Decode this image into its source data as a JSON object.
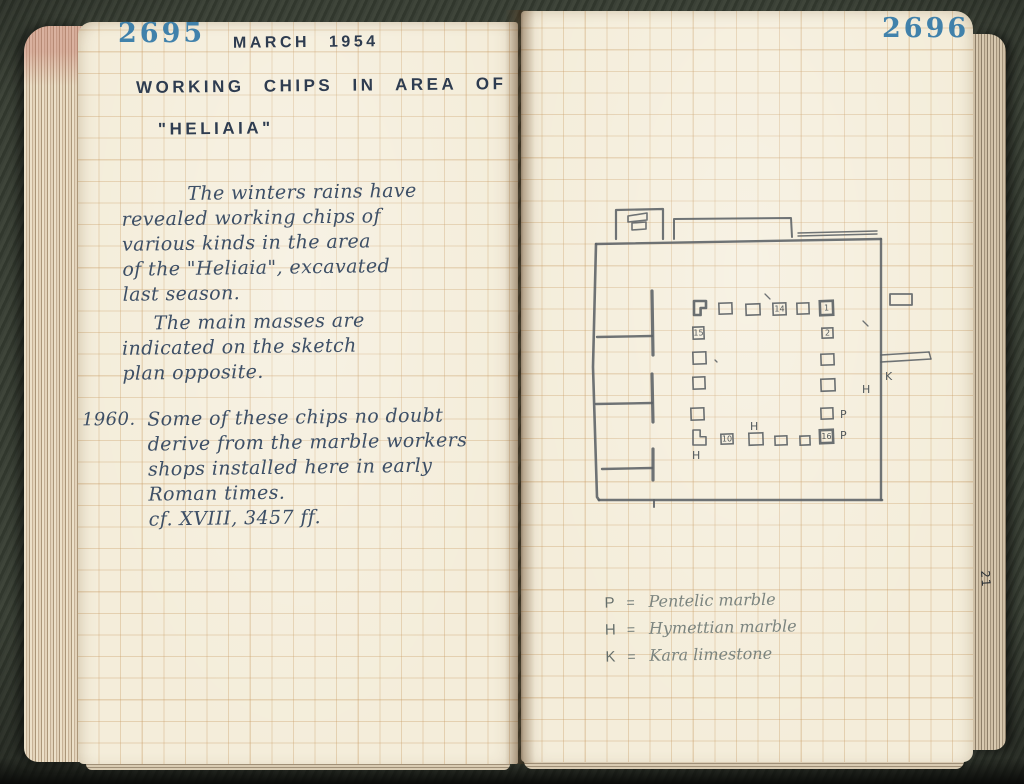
{
  "book": {
    "left_page_number": "2695",
    "right_page_number": "2696",
    "edge_marking": "21"
  },
  "left_page": {
    "date_heading": "MARCH 1954",
    "title_line1": "WORKING CHIPS IN AREA OF",
    "title_line2": "\"HELIAIA\"",
    "paragraph1_lines": [
      "The winters rains have",
      "revealed working chips of",
      "various kinds in the area",
      "of the \"Heliaia\", excavated",
      "last season."
    ],
    "paragraph2_lines": [
      "The main masses are",
      "indicated on the sketch",
      "plan opposite."
    ],
    "marginal_year": "1960.",
    "note_lines": [
      "Some of these chips no doubt",
      "derive from the marble workers",
      "shops installed here in early",
      "Roman times.",
      "cf. XVIII, 3457 ff."
    ]
  },
  "right_page": {
    "legend": [
      {
        "symbol": "P",
        "eq": "=",
        "meaning": "Pentelic marble"
      },
      {
        "symbol": "H",
        "eq": "=",
        "meaning": "Hymettian marble"
      },
      {
        "symbol": "K",
        "eq": "=",
        "meaning": "Kara limestone"
      }
    ],
    "plan": {
      "description": "pencil sketch plan of the Heliaia showing masses of working chips",
      "stroke_color": "#5b6165",
      "label_color": "#51585c",
      "walls": [
        {
          "points": "17,57 302,52",
          "w": 2.4
        },
        {
          "points": "302,52 302,313",
          "w": 2.4
        },
        {
          "points": "20,313 303,313",
          "w": 2.6
        },
        {
          "points": "17,57 14,180 18,310 20,313",
          "w": 2.6
        },
        {
          "points": "37,52 37,23 84,22 84,52",
          "w": 2.2
        },
        {
          "points": "49,29 68,26 68,33 49,35 49,29",
          "w": 1.6
        },
        {
          "points": "53,36 67,35 67,42 53,43 53,36",
          "w": 1.6
        },
        {
          "points": "95,52 95,32 212,31 213,50",
          "w": 2.0
        },
        {
          "points": "219,46 298,44",
          "w": 1.4
        },
        {
          "points": "219,49 298,47",
          "w": 1.4
        },
        {
          "points": "73,104 74,168",
          "w": 3.2
        },
        {
          "points": "73,187 74,235",
          "w": 3.2
        },
        {
          "points": "74,262 74,293",
          "w": 3.2
        },
        {
          "points": "18,150 73,149",
          "w": 2.4
        },
        {
          "points": "17,217 73,216",
          "w": 2.4
        },
        {
          "points": "23,282 73,281",
          "w": 2.4
        },
        {
          "points": "75,313 75,320",
          "w": 2.0
        },
        {
          "points": "311,107 333,107 333,118 311,118 311,107",
          "w": 1.8
        },
        {
          "points": "302,168 350,165",
          "w": 1.6
        },
        {
          "points": "302,175 352,172",
          "w": 1.6
        },
        {
          "points": "350,165 352,172",
          "w": 1.4
        },
        {
          "points": "186,107 191,112",
          "w": 1.3
        },
        {
          "points": "284,134 289,139",
          "w": 1.3
        },
        {
          "points": "136,173 138,175",
          "w": 1.3
        }
      ],
      "squares": [
        {
          "x": 115,
          "y": 114,
          "w": 12,
          "h": 14,
          "bold": true,
          "shape": "step-br"
        },
        {
          "x": 140,
          "y": 116,
          "w": 13,
          "h": 11
        },
        {
          "x": 167,
          "y": 117,
          "w": 14,
          "h": 11
        },
        {
          "x": 194,
          "y": 116,
          "w": 13,
          "h": 12,
          "label": "14"
        },
        {
          "x": 218,
          "y": 116,
          "w": 12,
          "h": 11
        },
        {
          "x": 241,
          "y": 114,
          "w": 13,
          "h": 14,
          "bold": true,
          "label": "1"
        },
        {
          "x": 114,
          "y": 140,
          "w": 11,
          "h": 12,
          "label": "15"
        },
        {
          "x": 243,
          "y": 141,
          "w": 11,
          "h": 10,
          "label": "2"
        },
        {
          "x": 114,
          "y": 165,
          "w": 13,
          "h": 12
        },
        {
          "x": 242,
          "y": 167,
          "w": 13,
          "h": 11
        },
        {
          "x": 114,
          "y": 190,
          "w": 12,
          "h": 12
        },
        {
          "x": 242,
          "y": 192,
          "w": 14,
          "h": 12
        },
        {
          "x": 112,
          "y": 221,
          "w": 13,
          "h": 12
        },
        {
          "x": 242,
          "y": 221,
          "w": 12,
          "h": 11
        },
        {
          "x": 114,
          "y": 243,
          "w": 13,
          "h": 15,
          "shape": "step-tr"
        },
        {
          "x": 142,
          "y": 247,
          "w": 12,
          "h": 10,
          "label": "10"
        },
        {
          "x": 170,
          "y": 246,
          "w": 14,
          "h": 12
        },
        {
          "x": 196,
          "y": 249,
          "w": 12,
          "h": 9
        },
        {
          "x": 221,
          "y": 249,
          "w": 10,
          "h": 9
        },
        {
          "x": 241,
          "y": 243,
          "w": 13,
          "h": 13,
          "bold": true,
          "label": "16"
        }
      ],
      "labels": [
        {
          "x": 306,
          "y": 193,
          "t": "K"
        },
        {
          "x": 283,
          "y": 206,
          "t": "H"
        },
        {
          "x": 261,
          "y": 231,
          "t": "P"
        },
        {
          "x": 261,
          "y": 252,
          "t": "P"
        },
        {
          "x": 113,
          "y": 272,
          "t": "H"
        },
        {
          "x": 171,
          "y": 243,
          "t": "H"
        }
      ]
    }
  },
  "colors": {
    "page_number_blue": "#3279a8",
    "heading_ink": "#2e3c50",
    "cursive_ink": "#3d4f66",
    "pencil": "#5b6165",
    "paper": "#f4edda",
    "grid_line": "#c6985e",
    "cloth_background": "#3a4036"
  }
}
